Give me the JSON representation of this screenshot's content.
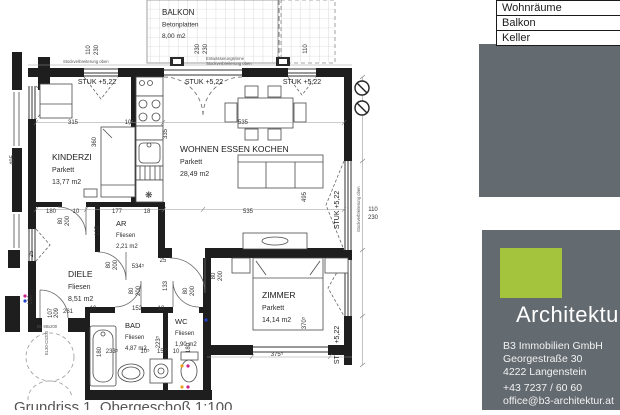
{
  "legend": {
    "rows": [
      "Wohnräume",
      "Balkon",
      "Keller"
    ]
  },
  "branding": {
    "wordmark": "Architektur",
    "company": "B3 Immobilien GmbH",
    "street": "Georgestraße 30",
    "city": "4222 Langenstein",
    "phone": "+43 7237 / 60 60",
    "email": "office@b3-architektur.at",
    "accent_green": "#a4c43e",
    "panel_gray": "#636a70"
  },
  "plan": {
    "caption": "Grundriss 1. Obergeschoß 1:100",
    "rooms": [
      {
        "name": "BALKON",
        "finish": "Betonplatten",
        "area": "8,00 m2",
        "x": 162,
        "y": 15,
        "size": 8
      },
      {
        "name": "KINDERZI",
        "finish": "Parkett",
        "area": "13,77 m2",
        "x": 52,
        "y": 160,
        "size": 8.5
      },
      {
        "name": "WOHNEN ESSEN KOCHEN",
        "finish": "Parkett",
        "area": "28,49 m2",
        "x": 180,
        "y": 152,
        "size": 8.5
      },
      {
        "name": "AR",
        "finish": "Fliesen",
        "area": "2,21 m2",
        "x": 116,
        "y": 226,
        "size": 7.5
      },
      {
        "name": "DIELE",
        "finish": "Fliesen",
        "area": "8,51 m2",
        "x": 68,
        "y": 277,
        "size": 8.5
      },
      {
        "name": "BAD",
        "finish": "Fliesen",
        "area": "4,87 m2",
        "x": 125,
        "y": 328,
        "size": 7.5
      },
      {
        "name": "WC",
        "finish": "Fliesen",
        "area": "1,90 m2",
        "x": 175,
        "y": 324,
        "size": 7.5
      },
      {
        "name": "ZIMMER",
        "finish": "Parkett",
        "area": "14,14 m2",
        "x": 262,
        "y": 298,
        "size": 8.5
      }
    ],
    "levels": [
      [
        "STUK +5,22",
        97,
        84,
        0
      ],
      [
        "STUK +5,22",
        204,
        84,
        0
      ],
      [
        "STUK +5,22",
        302,
        84,
        0
      ],
      [
        "STUK +5,22",
        339,
        210,
        -90
      ],
      [
        "STUK +5,22",
        339,
        345,
        -90
      ]
    ],
    "dims": [
      [
        "110",
        90,
        50,
        -90
      ],
      [
        "230",
        98,
        50,
        -90
      ],
      [
        "230",
        199,
        49,
        -90
      ],
      [
        "230",
        207,
        49,
        -90
      ],
      [
        "110",
        307,
        49,
        -90
      ],
      [
        "110",
        373,
        211,
        0
      ],
      [
        "230",
        373,
        219,
        0
      ],
      [
        "315",
        73,
        124,
        0
      ],
      [
        "10",
        128,
        124,
        0
      ],
      [
        "535",
        243,
        124,
        0
      ],
      [
        "360",
        96,
        142,
        -90
      ],
      [
        "335",
        167,
        134,
        -90
      ],
      [
        "495",
        14,
        160,
        -90
      ],
      [
        "495",
        306,
        197,
        -90
      ],
      [
        "180",
        51,
        213,
        0
      ],
      [
        "10",
        76,
        213,
        0
      ],
      [
        "177",
        117,
        213,
        0
      ],
      [
        "18",
        147,
        213,
        0
      ],
      [
        "535",
        248,
        213,
        0
      ],
      [
        "125",
        99,
        231,
        -90
      ],
      [
        "80",
        62,
        221,
        -90
      ],
      [
        "200",
        69,
        221,
        -90
      ],
      [
        "534⁵",
        138,
        268,
        0
      ],
      [
        "25",
        163,
        262,
        0
      ],
      [
        "133",
        167,
        286,
        -90
      ],
      [
        "25",
        33,
        254,
        -90
      ],
      [
        "80",
        110,
        265,
        -90
      ],
      [
        "200",
        117,
        265,
        -90
      ],
      [
        "80",
        133,
        291,
        -90
      ],
      [
        "200",
        140,
        291,
        -90
      ],
      [
        "80",
        187,
        291,
        -90
      ],
      [
        "200",
        194,
        291,
        -90
      ],
      [
        "80",
        215,
        276,
        -90
      ],
      [
        "200",
        222,
        276,
        -90
      ],
      [
        "261",
        68,
        313,
        0
      ],
      [
        "107",
        52,
        313,
        -90
      ],
      [
        "209",
        58,
        313,
        -90
      ],
      [
        "10",
        93,
        310,
        0
      ],
      [
        "152",
        137,
        310,
        0
      ],
      [
        "10",
        161,
        310,
        0
      ],
      [
        "180",
        32,
        300,
        -90
      ],
      [
        "180",
        101,
        352,
        -90
      ],
      [
        "223⁵",
        160,
        342,
        -90
      ],
      [
        "180",
        190,
        348,
        -90
      ],
      [
        "233⁵",
        112,
        353,
        0
      ],
      [
        "10⁵",
        145,
        353,
        0
      ],
      [
        "157",
        162,
        353,
        0
      ],
      [
        "10",
        176,
        353,
        0
      ],
      [
        "375⁵",
        277,
        356,
        0
      ],
      [
        "370⁵",
        306,
        323,
        -90
      ]
    ],
    "tiny": [
      [
        "Stockverbreiterung oben",
        63,
        63,
        0
      ],
      [
        "Entwässerungsrinne",
        206,
        60,
        0
      ],
      [
        "Stockverbreiterung oben",
        206,
        65,
        0
      ],
      [
        "Stockverbreiterung oben",
        360,
        232,
        -90
      ],
      [
        "DL 98x200",
        37,
        328,
        0
      ],
      [
        "EL30-CS200",
        48,
        355,
        -90
      ]
    ],
    "glyphs": [
      [
        "❋",
        145,
        198,
        9
      ]
    ]
  }
}
